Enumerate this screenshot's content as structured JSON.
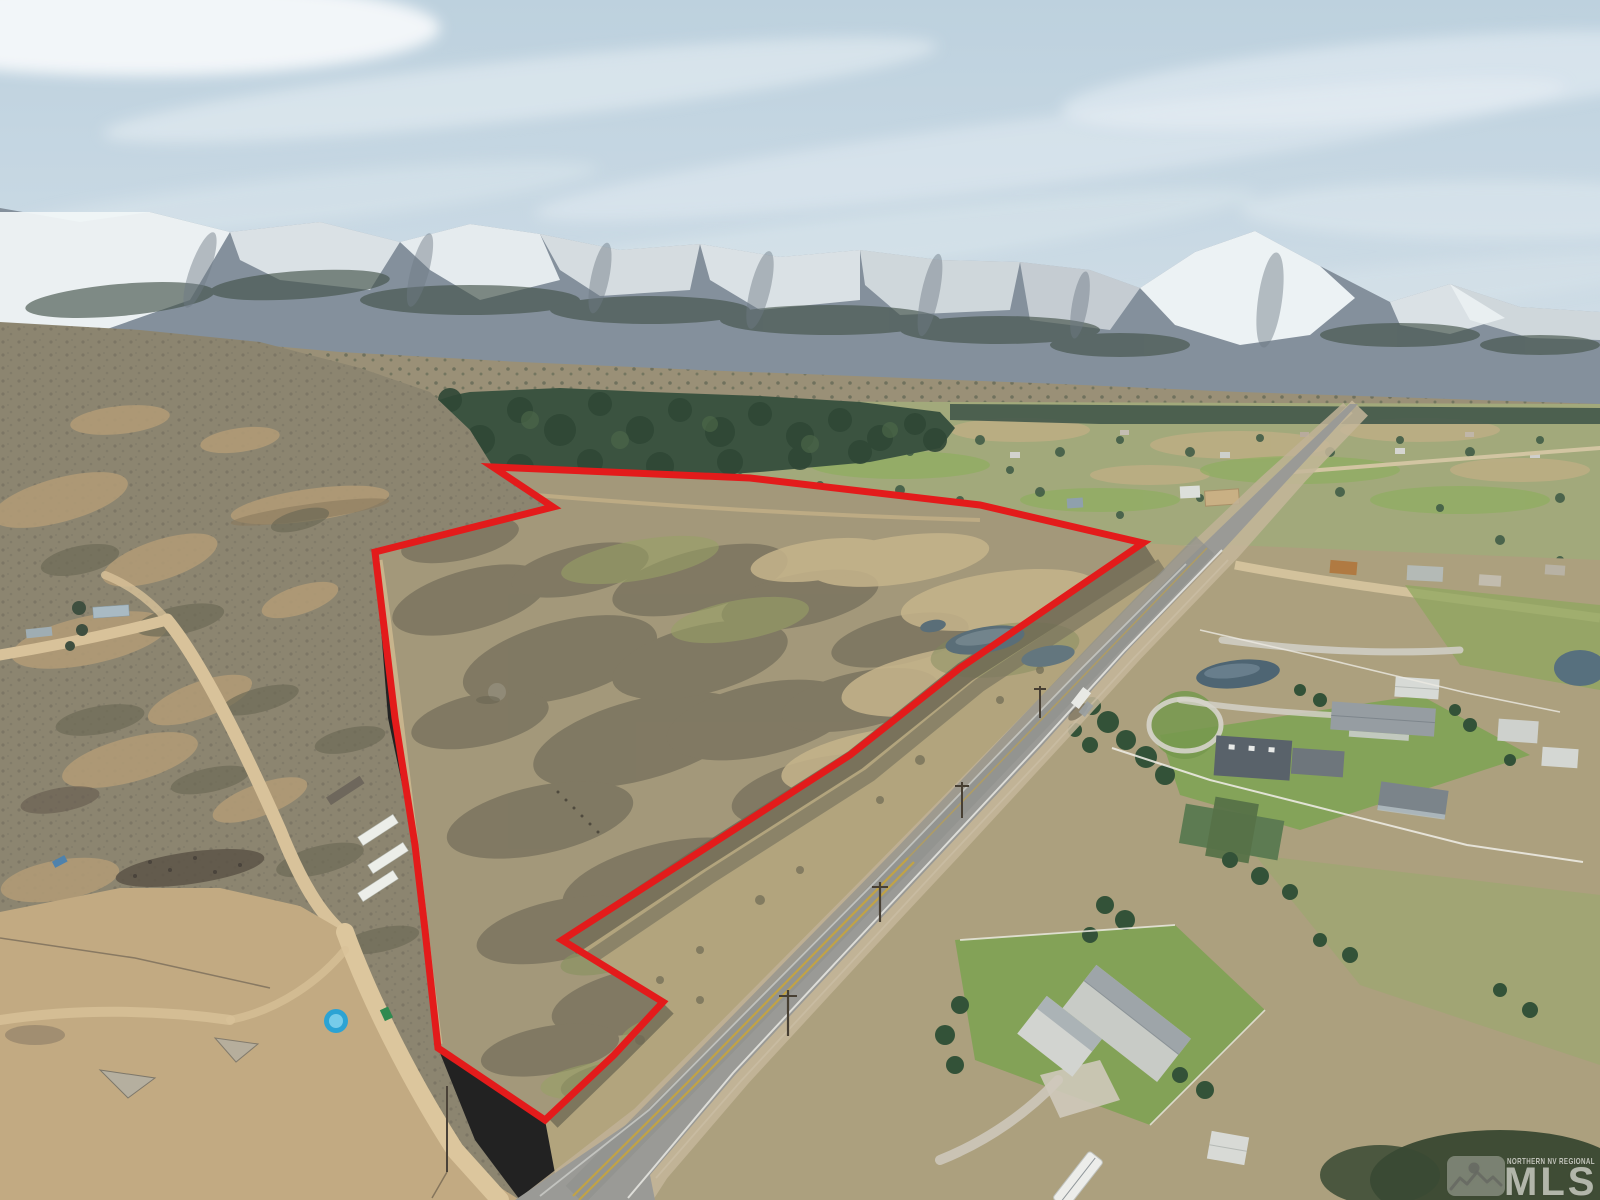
{
  "image": {
    "kind": "aerial-real-estate-listing-photo",
    "width": 1600,
    "height": 1200,
    "description": "Drone aerial photo of a vacant sagebrush land parcel outlined in red beside a two-lane highway, snow-capped mountain range behind, rural homes with lawns at right, dirt roads and trailers at lower left"
  },
  "boundary": {
    "label": "property-boundary",
    "color": "#e31b1b",
    "stroke_width": 7,
    "points": "493,467 750,478 980,505 1143,543 960,668 850,755 690,858 562,940 663,1002 614,1055 545,1120 438,1048 425,930 415,845 395,718 375,552 553,507"
  },
  "watermark": {
    "region_label": "NORTHERN NV REGIONAL",
    "brand": "MLS",
    "logo": "mountain-sun-logo",
    "text_color": "#f0efe9"
  },
  "palette": {
    "sky": "#c3d4e0",
    "cloud": "#edf3f6",
    "mountain_rock": "#84909c",
    "snow": "#f2f6f8",
    "mountain_forest": "#45544b",
    "foothill": "#9a9077",
    "valley_green": "#a2a97b",
    "forest_green": "#3b5340",
    "sage_hillside": "#8c8570",
    "parcel_field": "#a3987a",
    "brush_dark": "#78725e",
    "dry_grass": "#c6b48b",
    "dirt": "#c2aa82",
    "dirt_road": "#d8c29a",
    "asphalt": "#9a9a96",
    "lane_yellow": "#c7a43e",
    "lawn_green": "#7fa355",
    "pond": "#4e6573",
    "roof_dark": "#59626a",
    "roof_green": "#5d7b52",
    "house_white": "#cbcec9"
  }
}
